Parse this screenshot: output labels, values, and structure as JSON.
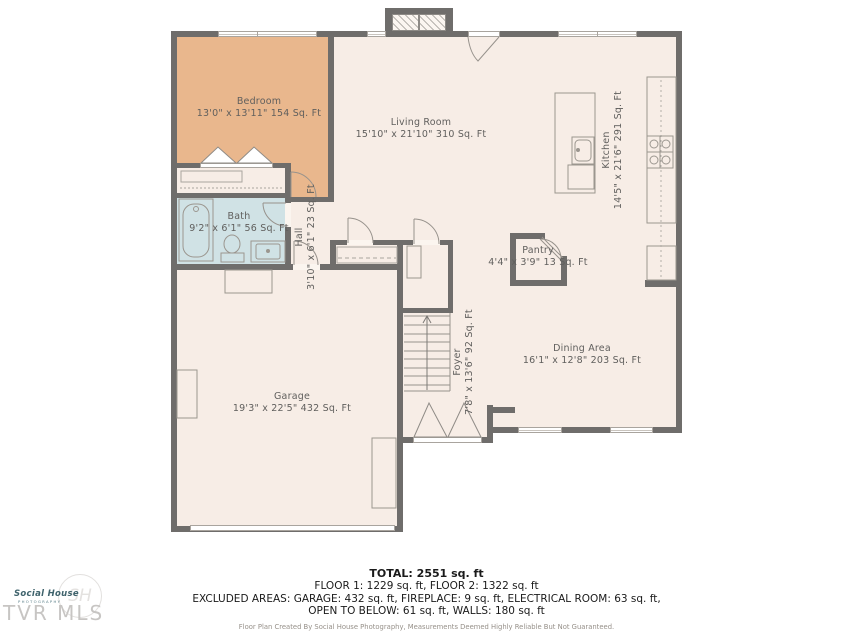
{
  "plan": {
    "rooms": {
      "bedroom": {
        "name": "Bedroom",
        "dims": "13'0\" x 13'11\" 154 Sq. Ft"
      },
      "living": {
        "name": "Living Room",
        "dims": "15'10\" x 21'10\" 310 Sq. Ft"
      },
      "kitchen": {
        "name": "Kitchen",
        "dims": "14'5\" x 21'6\" 291 Sq. Ft"
      },
      "bath": {
        "name": "Bath",
        "dims": "9'2\" x 6'1\" 56 Sq. Ft"
      },
      "hall": {
        "name": "Hall",
        "dims": "3'10\" x 6'1\" 23 Sq. Ft"
      },
      "pantry": {
        "name": "Pantry",
        "dims": "4'4\" x 3'9\" 13 Sq. Ft"
      },
      "dining": {
        "name": "Dining Area",
        "dims": "16'1\" x 12'8\" 203 Sq. Ft"
      },
      "foyer": {
        "name": "Foyer",
        "dims": "7'8\" x 13'6\" 92 Sq. Ft"
      },
      "garage": {
        "name": "Garage",
        "dims": "19'3\" x 22'5\" 432 Sq. Ft"
      }
    },
    "colors": {
      "wall": "#6f6d6b",
      "floor": "#f7ede6",
      "bedroom": "#e9b78d",
      "bath": "#d0e2e5"
    }
  },
  "footer": {
    "total": "TOTAL: 2551 sq. ft",
    "floors": "FLOOR 1: 1229 sq. ft, FLOOR 2: 1322 sq. ft",
    "excluded1": "EXCLUDED AREAS: GARAGE: 432 sq. ft, FIREPLACE: 9 sq. ft, ELECTRICAL ROOM: 63 sq. ft,",
    "excluded2": "OPEN TO BELOW: 61 sq. ft, WALLS: 180 sq. ft",
    "disclaimer": "Floor Plan Created By Social House Photography, Measurements Deemed Highly Reliable But Not Guaranteed."
  },
  "logo": {
    "brand_script": "Social House",
    "brand_sub": "PHOTOGRAPHY",
    "monogram": "SH",
    "mls": "TVR MLS"
  }
}
